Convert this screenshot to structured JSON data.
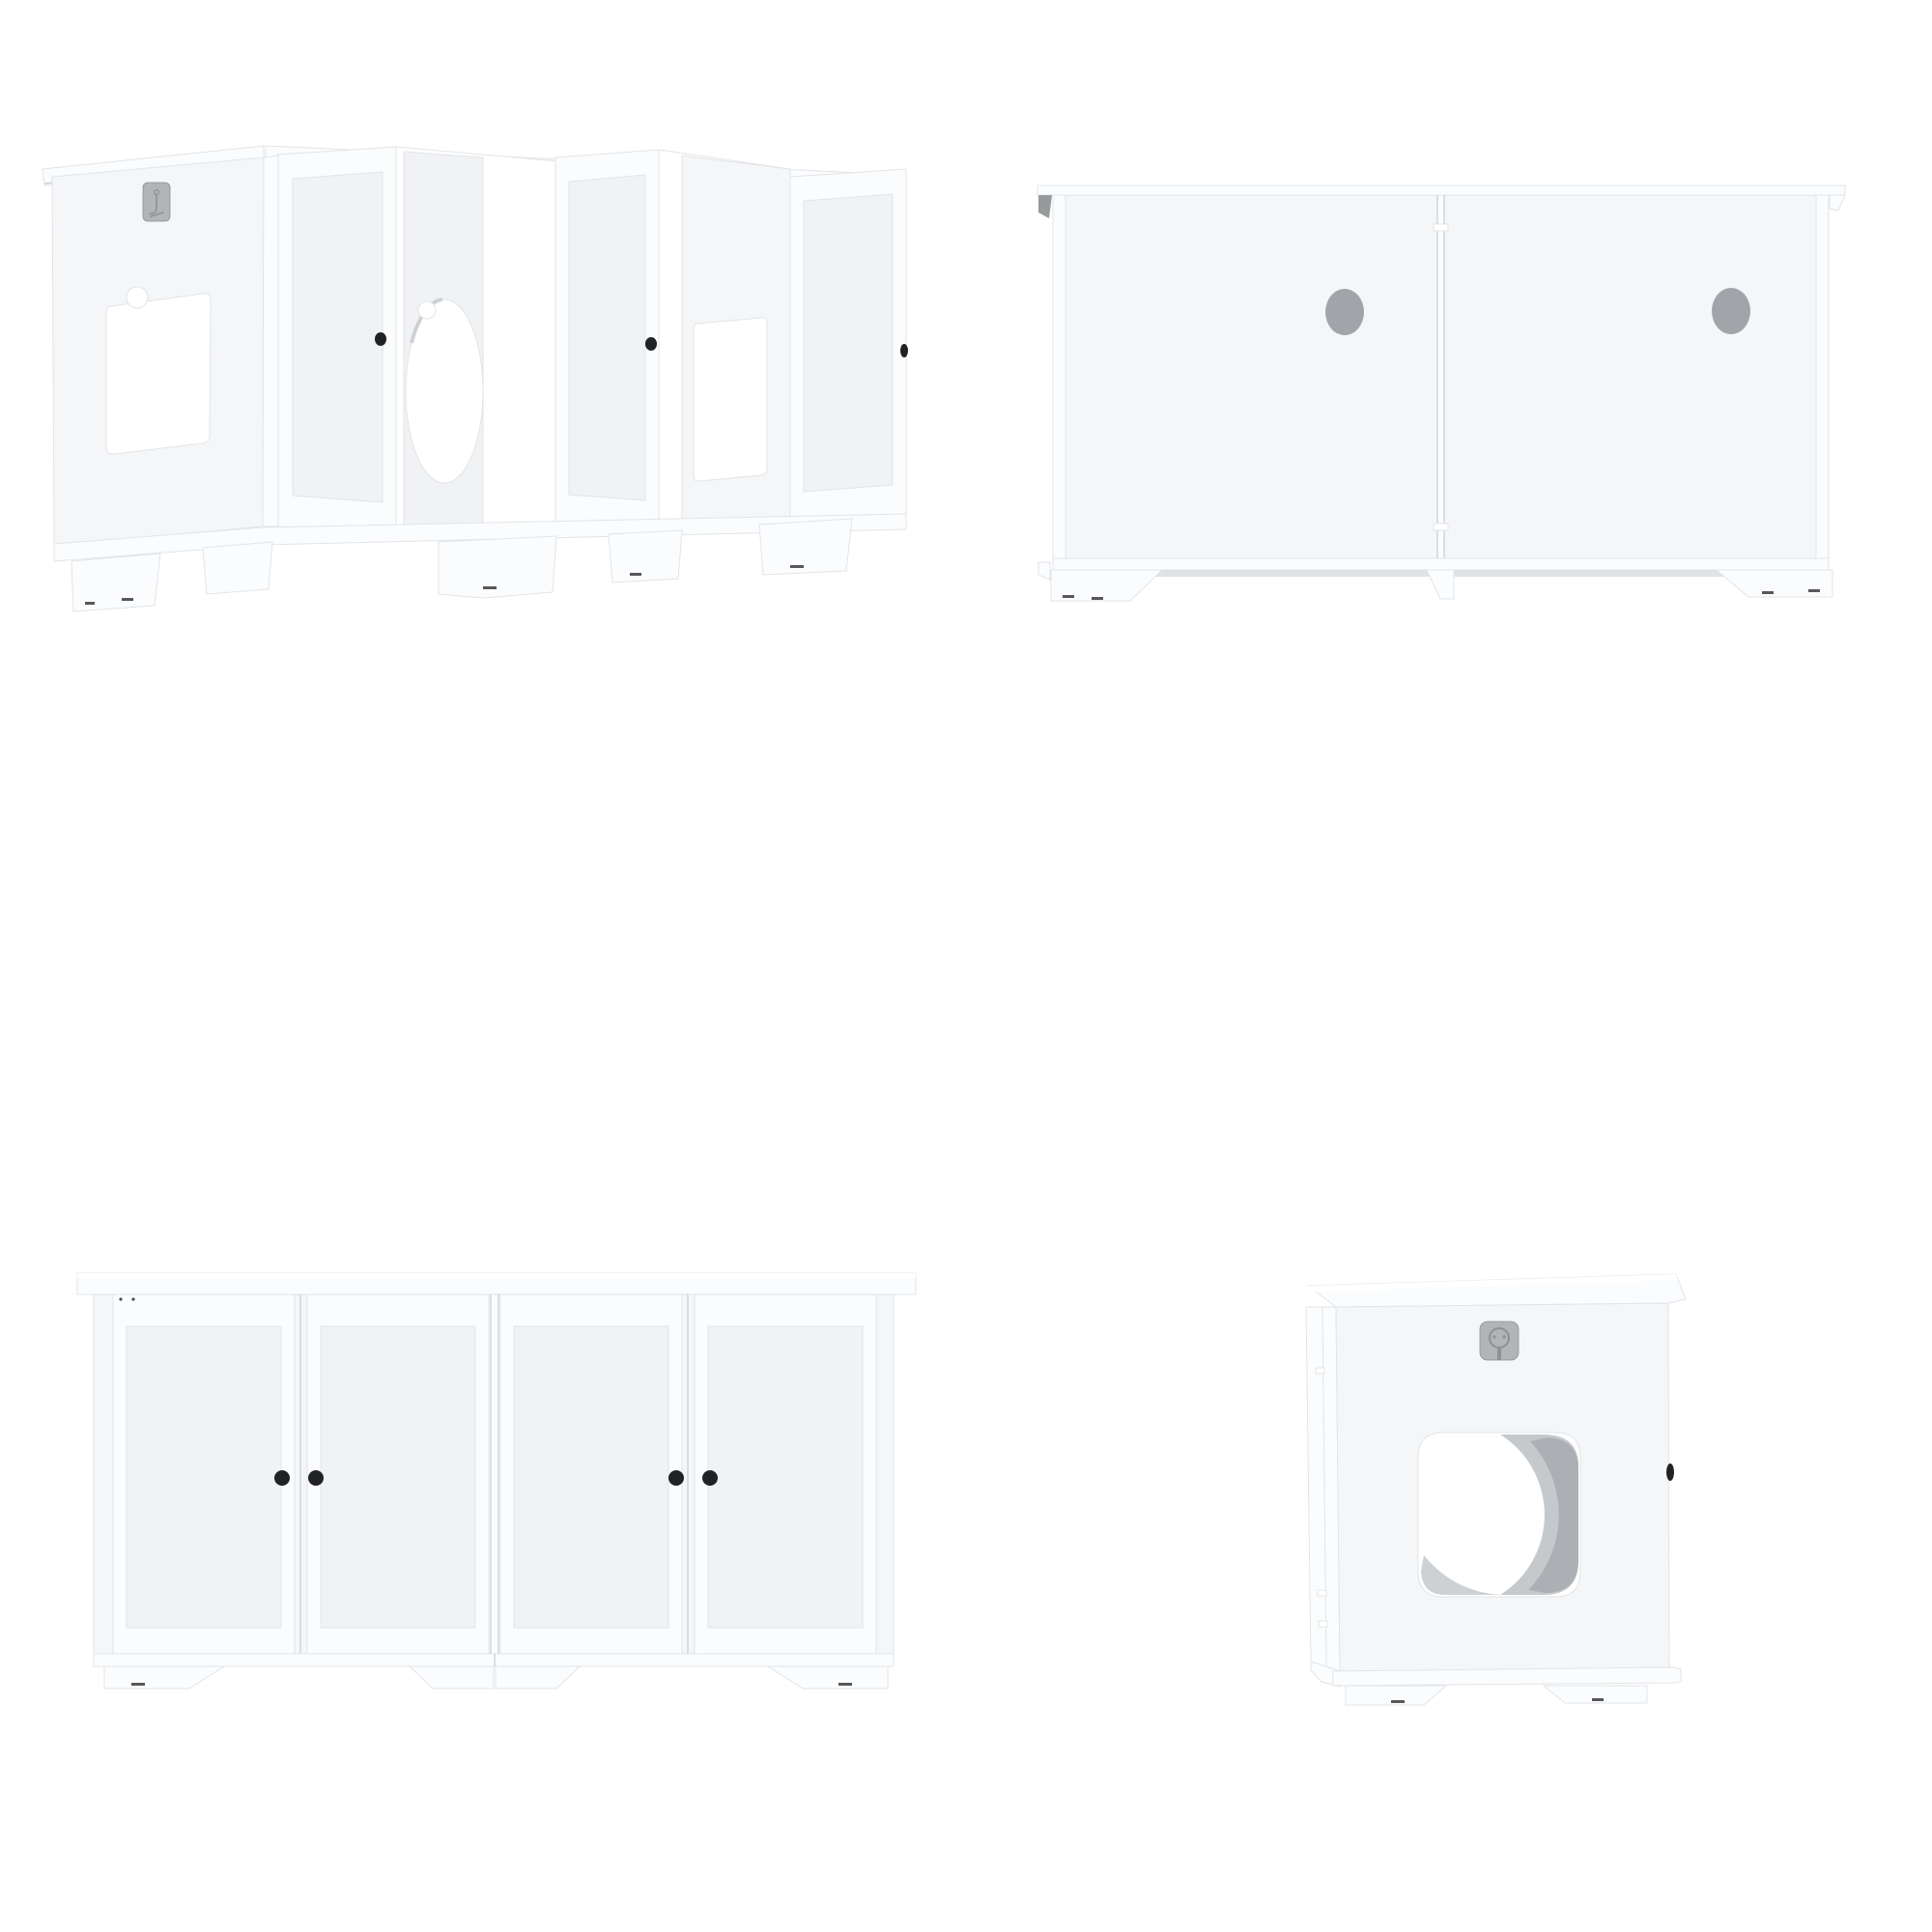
{
  "page": {
    "background": "#ffffff",
    "description": "Four-view product image grid of a white cat litter box enclosure cabinet"
  },
  "colors": {
    "bg": "#ffffff",
    "face": "#f5f6f8",
    "face-light": "#fbfcfd",
    "white": "#ffffff",
    "inset": "#f0f2f4",
    "edge": "#e2e4e7",
    "edge-dark": "#c7cacc",
    "hole": "#a1a5a9",
    "interior": "#a9adb1",
    "interior-light": "#c6c9cc",
    "plate": "#b2b4b6",
    "plate-dark": "#8e9194",
    "knob": "#212224",
    "tab": "#97999b"
  },
  "views": [
    {
      "id": "perspective-open-doors"
    },
    {
      "id": "back-view"
    },
    {
      "id": "front-view"
    },
    {
      "id": "side-view"
    }
  ]
}
